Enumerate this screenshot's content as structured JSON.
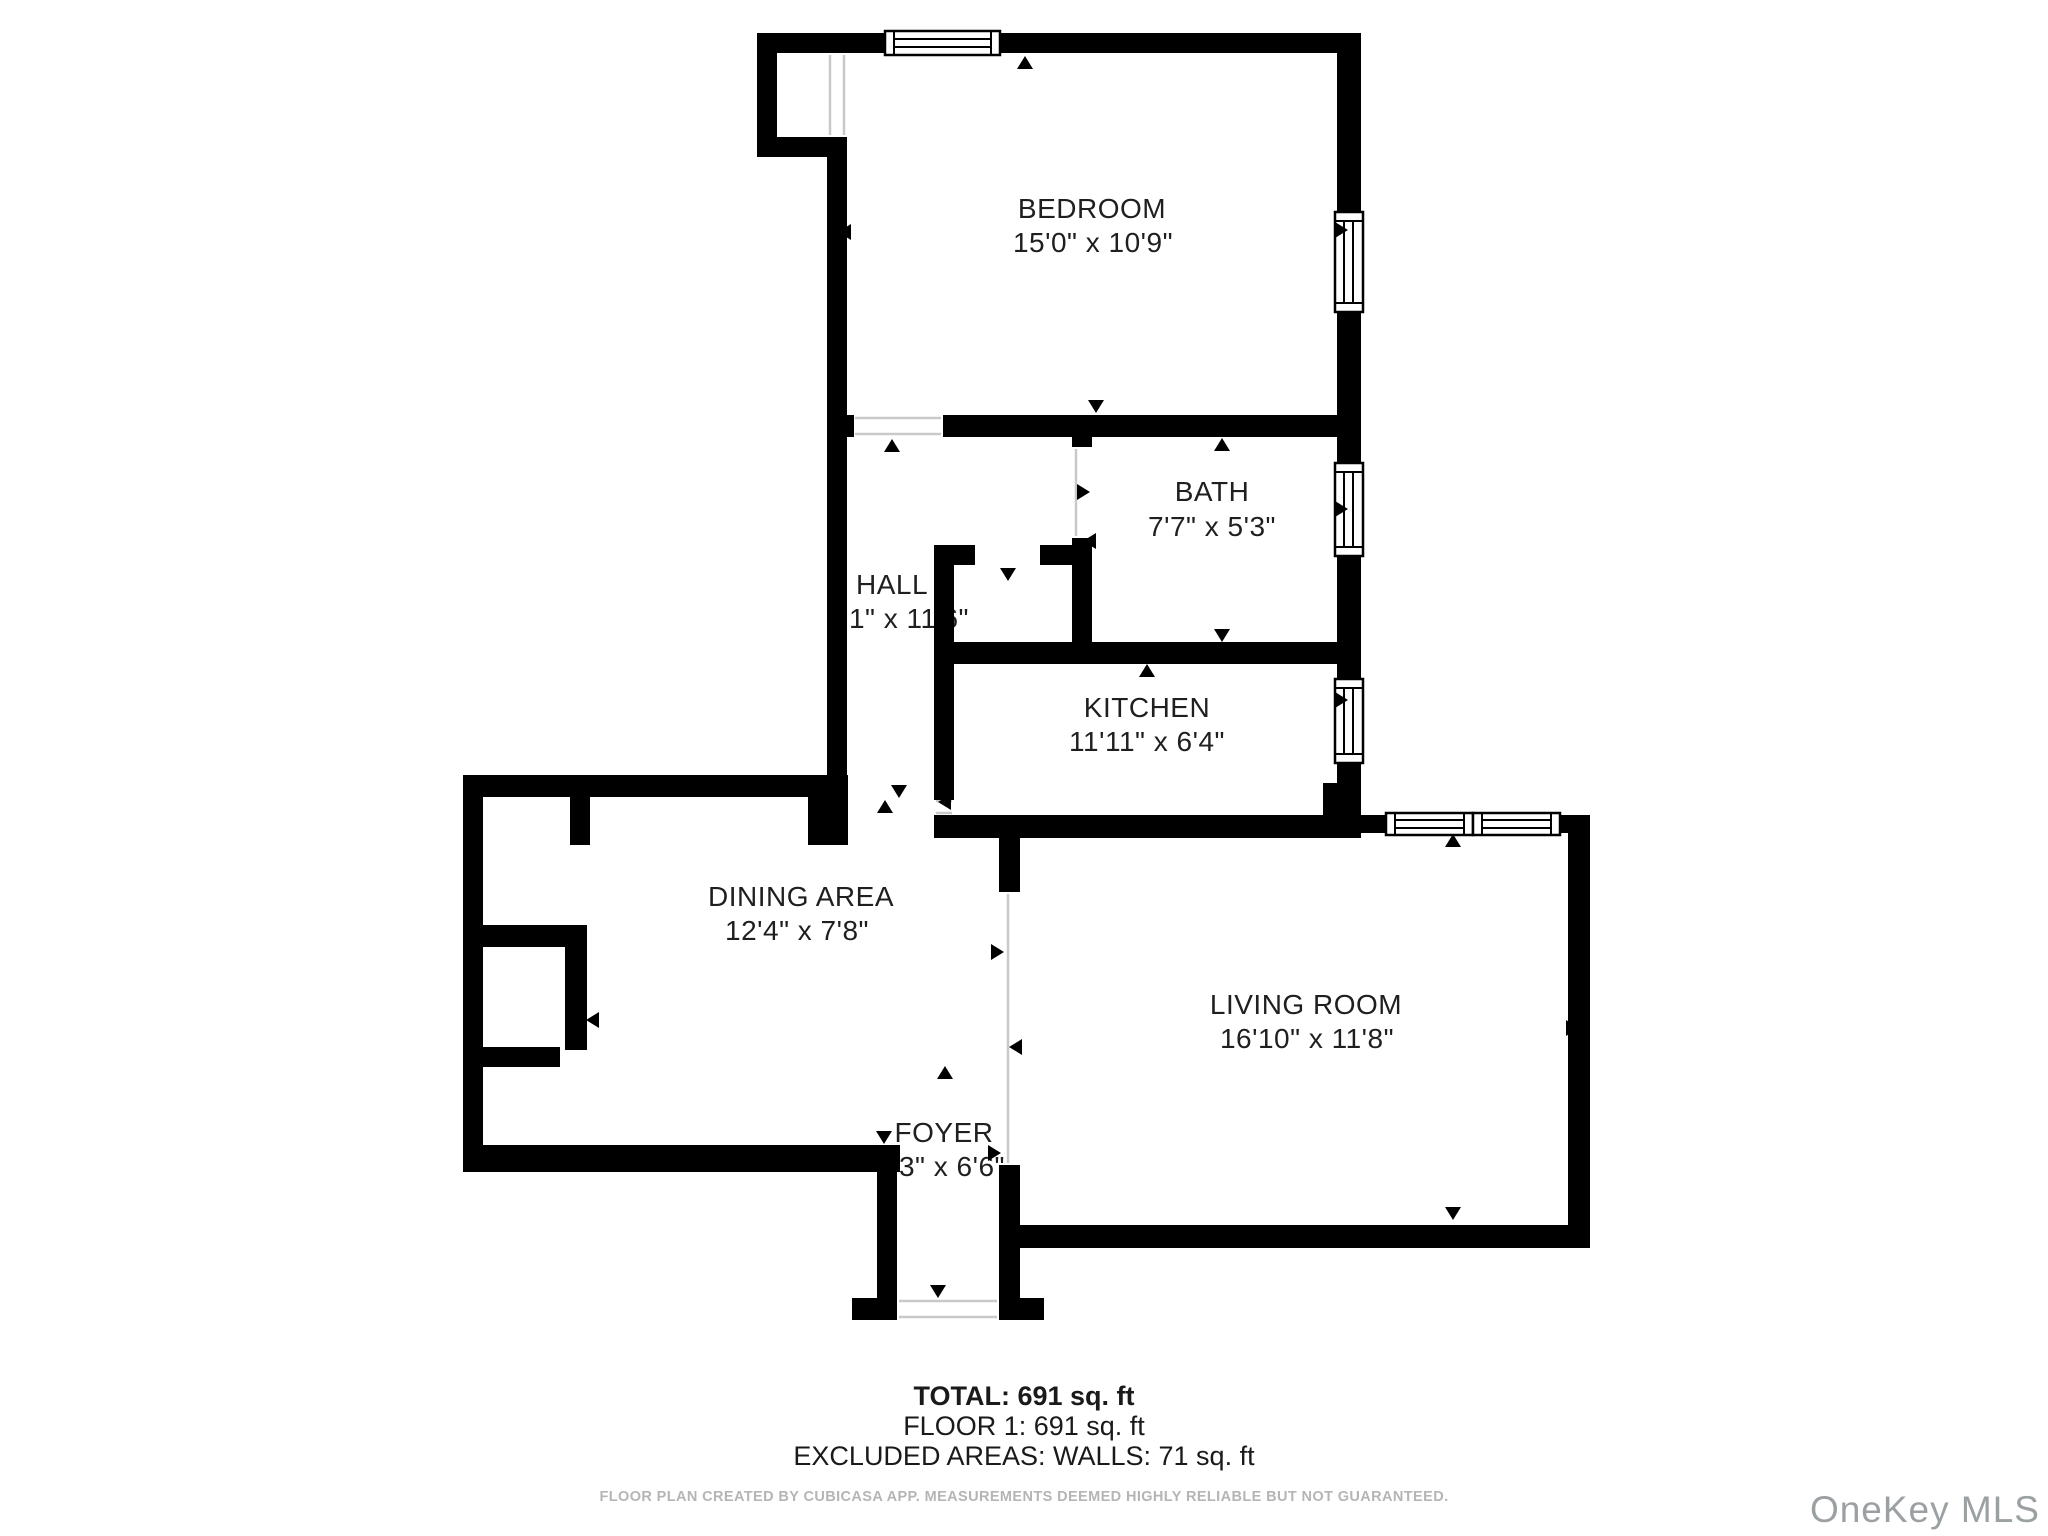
{
  "rooms": [
    {
      "name": "BEDROOM",
      "dimensions": "15'0\" x 10'9\""
    },
    {
      "name": "BATH",
      "dimensions": "7'7\" x 5'3\""
    },
    {
      "name": "HALL",
      "dimensions": "7'1\" x 11'6\""
    },
    {
      "name": "KITCHEN",
      "dimensions": "11'11\" x 6'4\""
    },
    {
      "name": "DINING AREA",
      "dimensions": "12'4\" x 7'8\""
    },
    {
      "name": "LIVING ROOM",
      "dimensions": "16'10\" x 11'8\""
    },
    {
      "name": "FOYER",
      "dimensions": "3'3\" x 6'6\""
    }
  ],
  "summary": {
    "total": "TOTAL: 691 sq. ft",
    "floor": "FLOOR 1: 691 sq. ft",
    "excluded": "EXCLUDED AREAS: WALLS: 71 sq. ft"
  },
  "footer": "FLOOR PLAN CREATED BY CUBICASA APP. MEASUREMENTS DEEMED HIGHLY RELIABLE BUT NOT GUARANTEED.",
  "watermark": "OneKey MLS",
  "colors": {
    "wall": "#000000",
    "room_text": "#1f1f1f",
    "summary_text": "#1a1a1a",
    "footer_text": "#b5b5b5",
    "watermark_text": "#9ba0a3",
    "door_line": "#c9c9c9",
    "background": "#ffffff"
  }
}
